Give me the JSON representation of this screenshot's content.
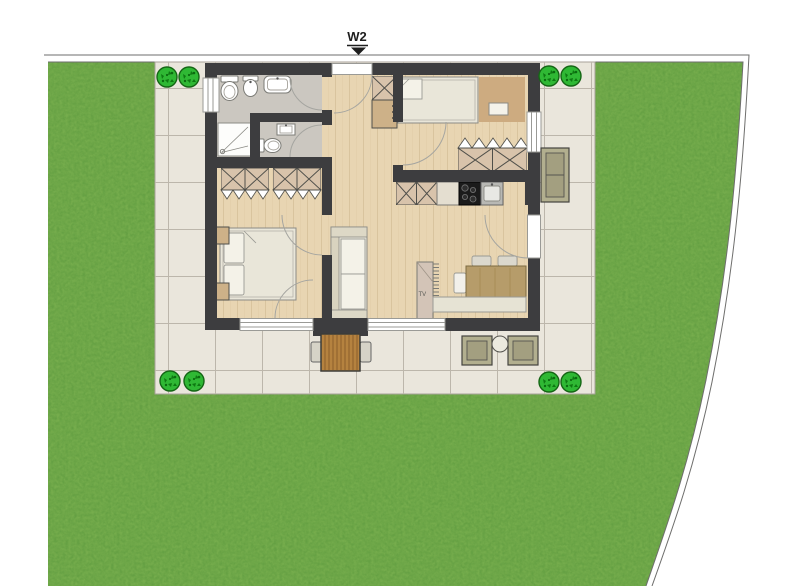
{
  "plan": {
    "unit_label": "W2"
  },
  "living_room": {
    "tv_label": "TV"
  },
  "site": {
    "bush_count": 8
  },
  "colors": {
    "lawn": "#76ad4d",
    "lawn_texture": "#55943a",
    "patio": "#eae6dc",
    "tile_grout": "#bcb6ab",
    "wall": "#3d3d3f",
    "wood_floor": "#e8d5b2",
    "wood_plank_line": "#d9c49e",
    "bathroom_floor": "#cbc7c0",
    "bedroom_rug": "#cdab80",
    "bush": "#2fb834",
    "wardrobe_fill": "#d8c3ab",
    "dining_table": "#b69c6a",
    "stove": "#1b1b1b",
    "outdoor_furniture": "#b2af8f",
    "outdoor_table_wood": "#b5823f",
    "boundary_line": "#6e6e6c"
  }
}
